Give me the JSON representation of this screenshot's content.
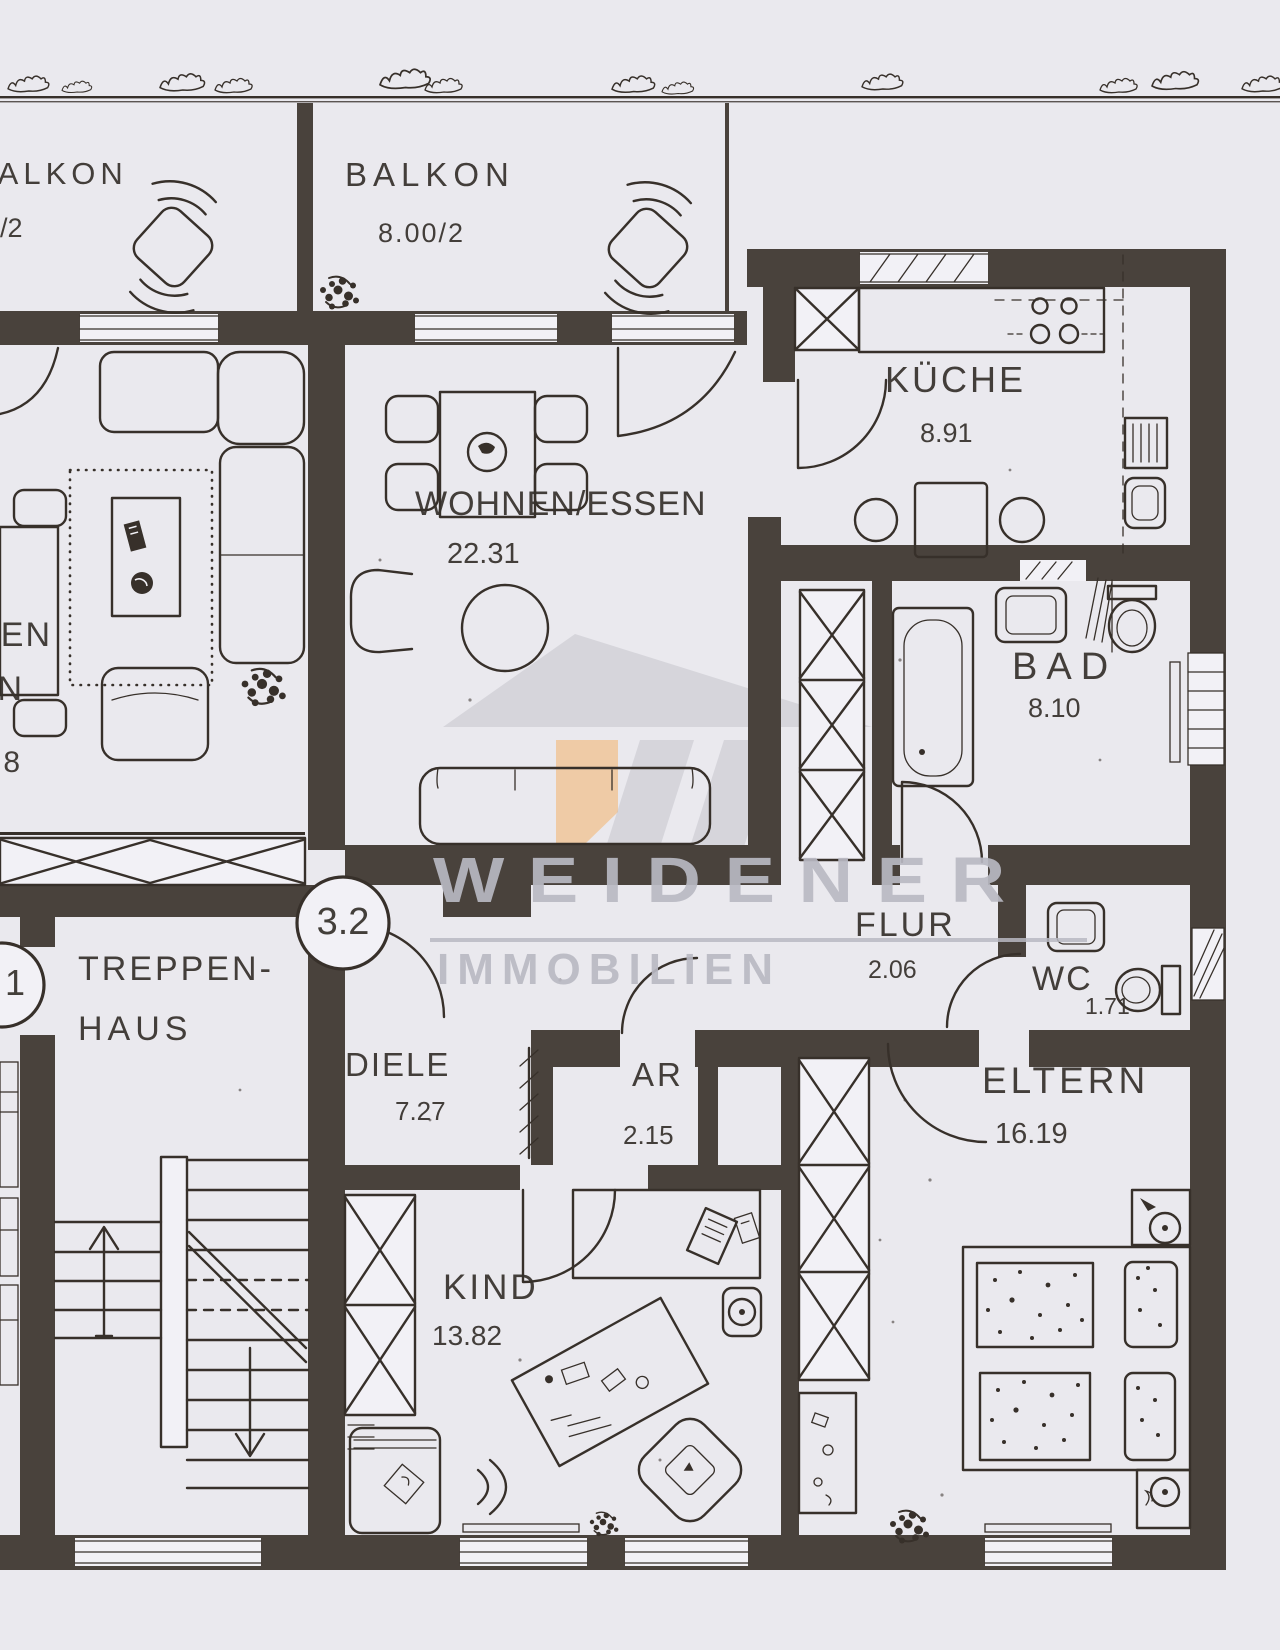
{
  "watermark": {
    "line1": "WEIDENER",
    "line2": "IMMOBILIEN"
  },
  "units": {
    "current": "3.2",
    "adjacent_fragment": "1"
  },
  "rooms": {
    "balkon_left": {
      "name": "BALKON",
      "area": "/2"
    },
    "balkon": {
      "name": "BALKON",
      "area": "8.00/2"
    },
    "kueche": {
      "name": "KÜCHE",
      "area": "8.91"
    },
    "wohnen_essen": {
      "name": "WOHNEN/ESSEN",
      "area": "22.31"
    },
    "bad": {
      "name": "BAD",
      "area": "8.10"
    },
    "flur": {
      "name": "FLUR",
      "area": "2.06"
    },
    "wc": {
      "name": "WC",
      "area": "1.71"
    },
    "eltern": {
      "name": "ELTERN",
      "area": "16.19"
    },
    "kind": {
      "name": "KIND",
      "area": "13.82"
    },
    "diele": {
      "name": "DIELE",
      "area": "7.27"
    },
    "ar": {
      "name": "AR",
      "area": "2.15"
    },
    "treppenhaus": {
      "name_line1": "TREPPEN-",
      "name_line2": "HAUS"
    },
    "neighbor_partial": {
      "fragment_line1": "EN",
      "fragment_line2": "N",
      "area_fragment": "8"
    }
  },
  "colors": {
    "paper": "#eae9ee",
    "ink": "#37302a",
    "wall": "#49423c",
    "watermark_gray": "#b9b9c1",
    "watermark_orange": "#f2b877"
  }
}
